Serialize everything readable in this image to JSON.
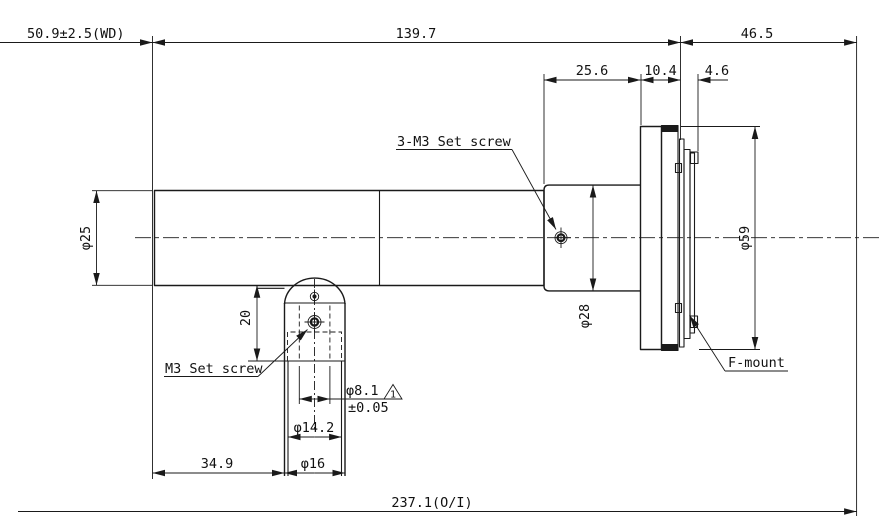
{
  "drawing": {
    "dimensions": {
      "working_distance": "50.9±2.5(WD)",
      "body_length": "139.7",
      "rear_length": "46.5",
      "rear_barrel_length": "25.6",
      "flange_width": "10.4",
      "mount_depth": "4.6",
      "barrel_diameter": "φ25",
      "rear_diameter": "φ28",
      "flange_diameter": "φ59",
      "post_offset": "20",
      "bore_diameter": "φ8.1",
      "bore_tolerance": "±0.05",
      "bore_note_flag": "1",
      "counterbore_diameter": "φ14.2",
      "post_diameter": "φ16",
      "post_position": "34.9",
      "overall_length": "237.1(O/I)"
    },
    "labels": {
      "set_screw_3m3": "3-M3 Set screw",
      "set_screw_m3": "M3 Set screw",
      "f_mount": "F-mount"
    },
    "colors": {
      "line": "#1a1a1a",
      "background": "#ffffff"
    }
  }
}
